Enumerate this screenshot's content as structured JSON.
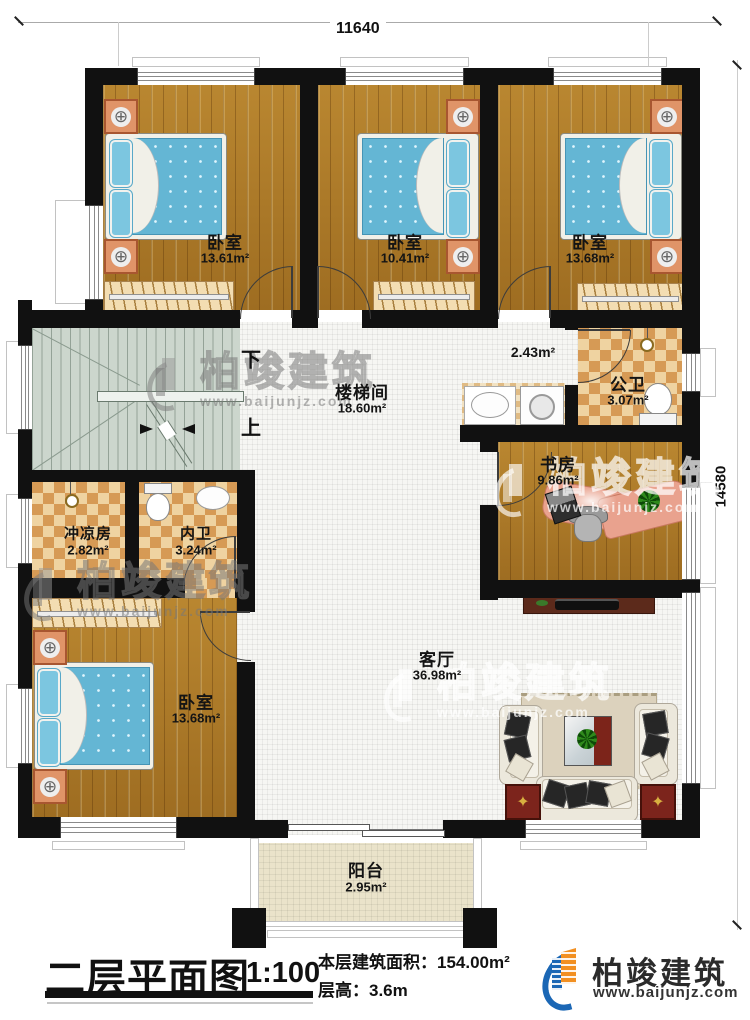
{
  "dimensions": {
    "top": "11640",
    "right": "14580"
  },
  "rooms": [
    {
      "id": "bedroom-1",
      "name": "卧室",
      "area": "13.61m²"
    },
    {
      "id": "bedroom-2",
      "name": "卧室",
      "area": "10.41m²"
    },
    {
      "id": "bedroom-3",
      "name": "卧室",
      "area": "13.68m²"
    },
    {
      "id": "stairwell",
      "name": "楼梯间",
      "area": "18.60m²"
    },
    {
      "id": "vestibule",
      "name": "",
      "area": "2.43m²"
    },
    {
      "id": "public-bath",
      "name": "公卫",
      "area": "3.07m²"
    },
    {
      "id": "study",
      "name": "书房",
      "area": "9.86m²"
    },
    {
      "id": "shower-room",
      "name": "冲凉房",
      "area": "2.82m²"
    },
    {
      "id": "inner-bath",
      "name": "内卫",
      "area": "3.24m²"
    },
    {
      "id": "bedroom-4",
      "name": "卧室",
      "area": "13.68m²"
    },
    {
      "id": "living-room",
      "name": "客厅",
      "area": "36.98m²"
    },
    {
      "id": "balcony",
      "name": "阳台",
      "area": "2.95m²"
    }
  ],
  "stairs": {
    "down": "下",
    "up": "上"
  },
  "title": {
    "text": "二层平面图",
    "scale": "1:100"
  },
  "info": {
    "area_label": "本层建筑面积：",
    "area_value": "154.00m²",
    "height_label": "层高：",
    "height_value": "3.6m"
  },
  "brand": {
    "name": "柏竣建筑",
    "url": "www.baijunjz.com"
  },
  "watermark": {
    "name": "柏竣建筑",
    "url": "www.baijunjz.com"
  },
  "icons": {
    "knob": "⊕",
    "lamp": "✦"
  },
  "colors": {
    "brand_blue": "#1b67b5",
    "brand_orange": "#f29022",
    "wall": "#111111"
  }
}
